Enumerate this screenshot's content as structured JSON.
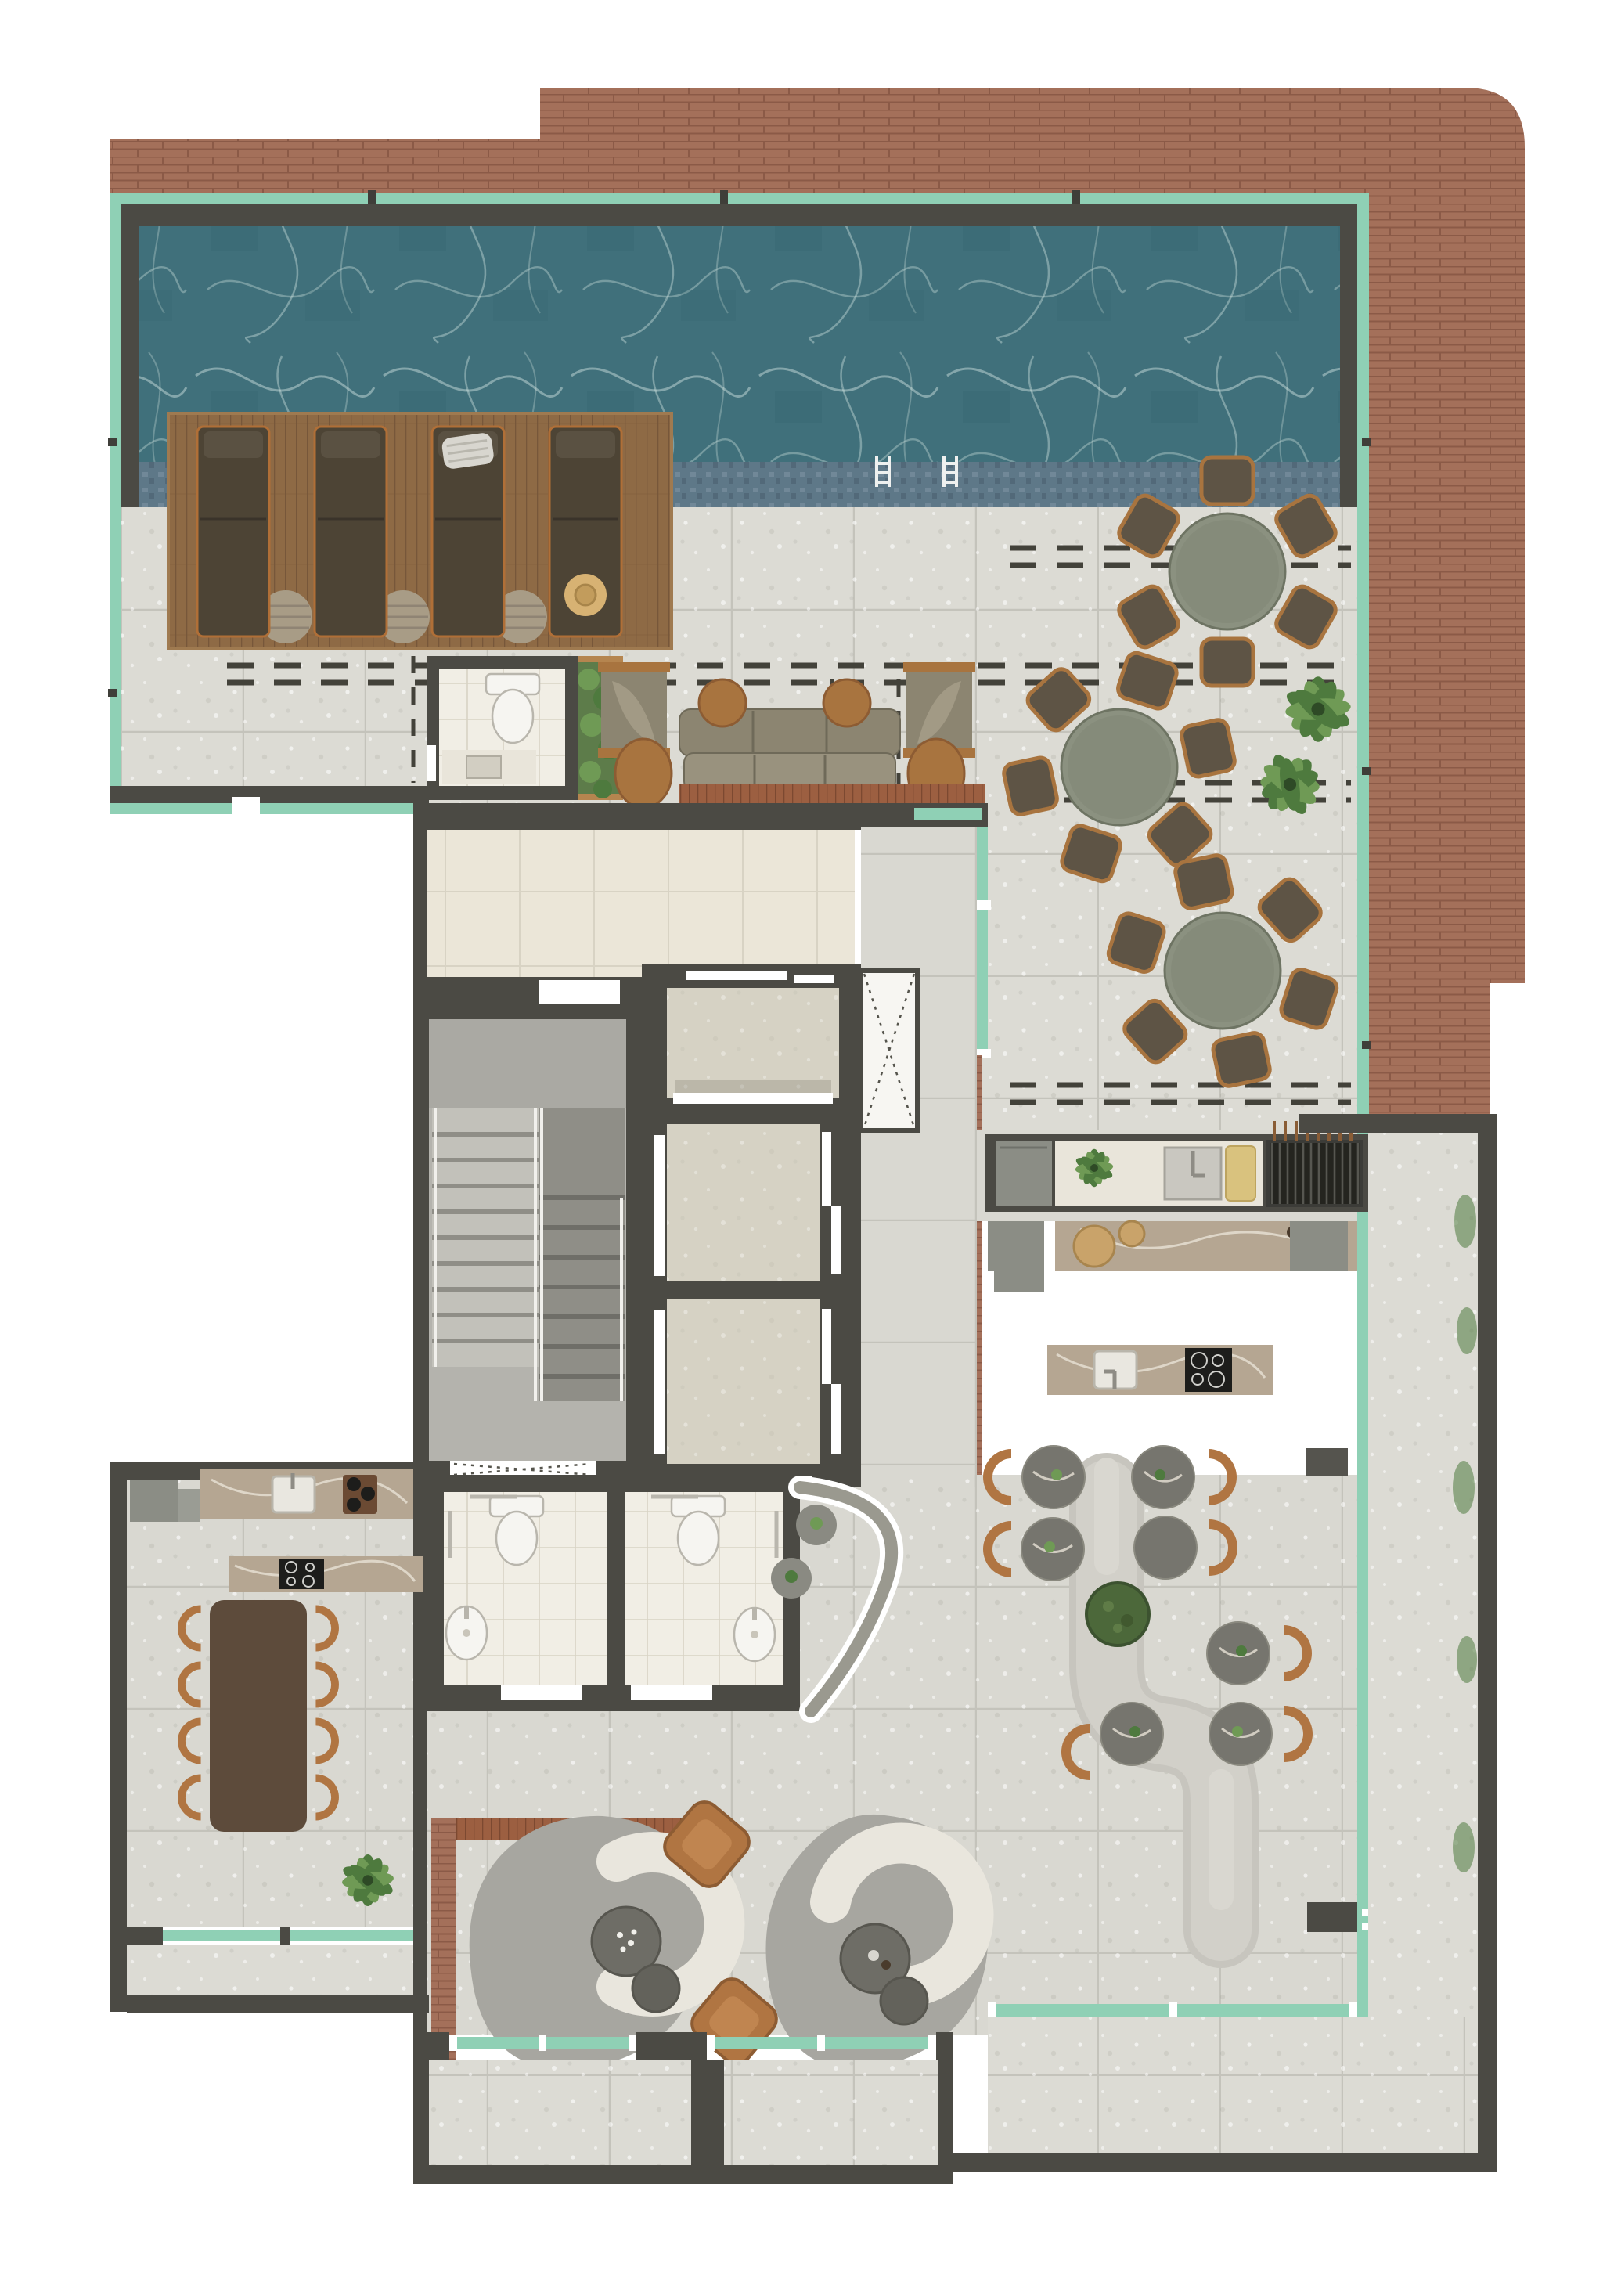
{
  "palette": {
    "bg": "#ffffff",
    "brick": "#a4705a",
    "brick_dark": "#8b5a47",
    "glass": "#8fd0b5",
    "wall": "#4b4a44",
    "water": "#40707b",
    "caustic": "#d8e9e4",
    "mosaic": "#5e7888",
    "wood_deck": "#8e6a45",
    "wood_dark": "#77573a",
    "wood_trim": "#a8743f",
    "lounger": "#4d4435",
    "lounger_frame": "#b06f37",
    "floor_out": "#dcdbd4",
    "floor_in": "#d9d8d1",
    "floor_joint": "#c4c3bb",
    "tile_white": "#f1eee5",
    "tile_cream": "#ebe6d8",
    "tile_joint": "#d8d3c4",
    "concrete": "#b4b3ad",
    "concrete_dark": "#8f8e87",
    "stair_tread": "#c2c1ba",
    "table_sage": "#8b9180",
    "chair_dark": "#5e5445",
    "tan": "#b07542",
    "sofa_olive": "#8c8571",
    "sofa_olive_light": "#99927e",
    "bench_wood": "#9c5f41",
    "marble": "#b5a692",
    "marble_white": "#e9e5da",
    "appliance": "#8b8d85",
    "grill": "#24241f",
    "banquette": "#c7c5be",
    "banquette_light": "#d9d7d0",
    "marble_dark": "#76756e",
    "rug": "#a7a6a0",
    "cream": "#e9e6dd",
    "moss": "#4c683a",
    "plant": "#4e7a3e",
    "plant_light": "#6f9a55",
    "fixture": "#f6f5f1",
    "dash": "#43423a"
  },
  "inventory": {
    "pool": {
      "ladders": 2
    },
    "deck": {
      "sun_loungers": 4,
      "side_tables": 3,
      "towels": 1,
      "sun_hats": 1
    },
    "outdoor_dining": {
      "round_tables": 3,
      "chairs_per_table": 6
    },
    "outdoor_lounge": {
      "sofas": 1,
      "sling_chairs": 2,
      "round_side_tables": 4,
      "wood_bench": 1
    },
    "core": {
      "elevators": 3,
      "stair_flights": 2,
      "vent_shafts": 1
    },
    "gourmet": {
      "grill_skewers": 8,
      "sinks": 3,
      "island_burners": 4,
      "cutting_boards": 1,
      "bar_boards": 2
    },
    "restrooms": {
      "accessible_bathrooms": 2,
      "pool_wc": 1,
      "toilets": 3,
      "basins": 3
    },
    "banquette_lounge": {
      "s_bench": 1,
      "backrests": 2,
      "marble_tables": 7,
      "tan_chairs": 7,
      "moss_planter": 1
    },
    "private_dining": {
      "table_seats": 8,
      "wall_burners": 3,
      "island_burners": 4,
      "fridges": 1
    },
    "sofa_lounge": {
      "curved_sofas": 2,
      "leather_lounge_chairs": 2,
      "rugs": 2,
      "nesting_coffee_tables": 4
    },
    "plants": {
      "potted": 7,
      "hedge_planters": 1
    }
  }
}
